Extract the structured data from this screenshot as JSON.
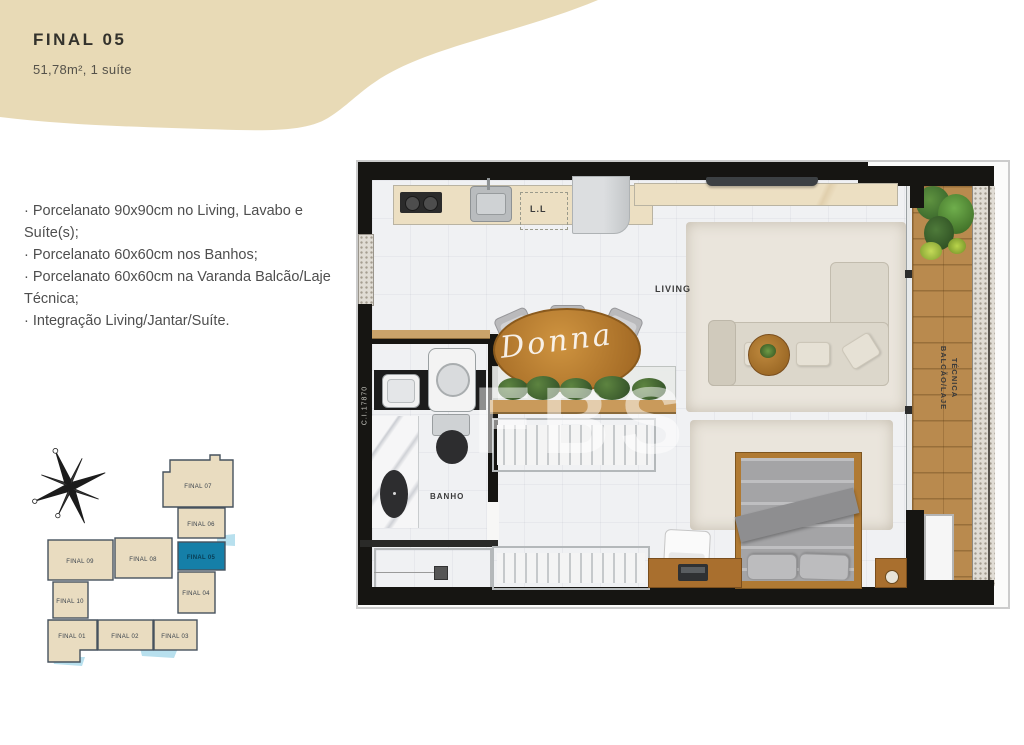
{
  "header": {
    "title": "FINAL 05",
    "subtitle": "51,78m², 1 suíte"
  },
  "specs": [
    "· Porcelanato 90x90cm no Living, Lavabo e Suíte(s);",
    "· Porcelanato 60x60cm nos Banhos;",
    "· Porcelanato 60x60cm na Varanda Balcão/Laje Técnica;",
    "· Integração Living/Jantar/Suíte."
  ],
  "floor_plan": {
    "room_labels": {
      "living": "LIVING",
      "bathroom": "BANHO",
      "laundry": "L.L"
    },
    "balcony_label": {
      "line1": "BALCÃO/LAJE",
      "line2": "TÉCNICA"
    },
    "registration_number": "C.I.17870",
    "watermark": {
      "script": "Donna",
      "letters": "FBS"
    }
  },
  "key_plan": {
    "units": [
      {
        "label": "FINAL 07",
        "highlighted": false
      },
      {
        "label": "FINAL 06",
        "highlighted": false
      },
      {
        "label": "FINAL 05",
        "highlighted": true
      },
      {
        "label": "FINAL 04",
        "highlighted": false
      },
      {
        "label": "FINAL 09",
        "highlighted": false
      },
      {
        "label": "FINAL 08",
        "highlighted": false
      },
      {
        "label": "FINAL 10",
        "highlighted": false
      },
      {
        "label": "FINAL 01",
        "highlighted": false
      },
      {
        "label": "FINAL 02",
        "highlighted": false
      },
      {
        "label": "FINAL 03",
        "highlighted": false
      }
    ],
    "colors": {
      "unit_beige": "#e9dcc0",
      "highlight_teal": "#157fa8",
      "water_blue": "#b8e0ee"
    }
  },
  "colors": {
    "blob_beige": "#e8dab6",
    "wall_black": "#161512"
  }
}
